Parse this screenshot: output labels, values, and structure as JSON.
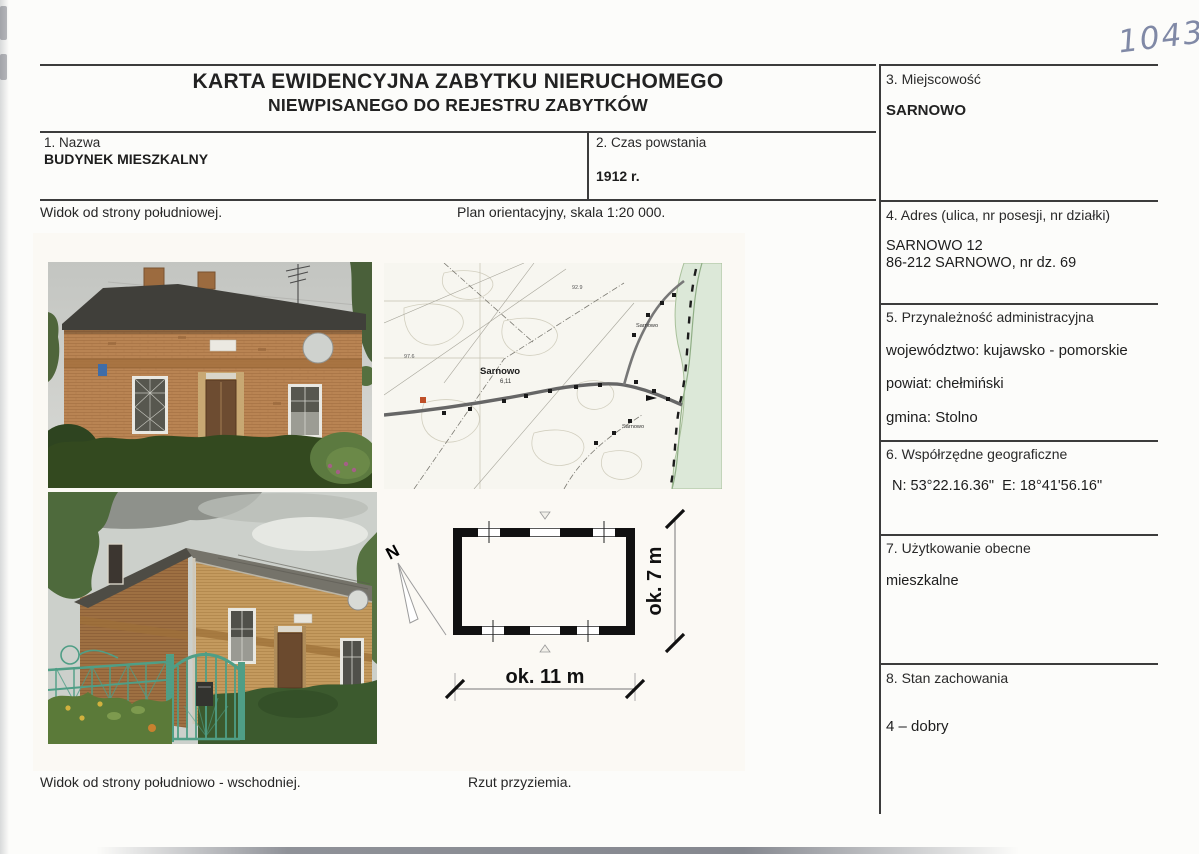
{
  "header": {
    "handwritten_number": "10438",
    "title_line1": "KARTA EWIDENCYJNA ZABYTKU NIERUCHOMEGO",
    "title_line2": "NIEWPISANEGO DO REJESTRU ZABYTKÓW"
  },
  "fields": {
    "nazwa": {
      "label": "1. Nazwa",
      "value": "BUDYNEK MIESZKALNY"
    },
    "czas_powstania": {
      "label": "2. Czas powstania",
      "value": "1912 r."
    },
    "miejscowosc": {
      "label": "3. Miejscowość",
      "value": "SARNOWO"
    },
    "adres": {
      "label": "4. Adres (ulica, nr posesji, nr działki)",
      "line1": "SARNOWO 12",
      "line2": "86-212 SARNOWO, nr dz. 69"
    },
    "przynaleznosc": {
      "label": "5. Przynależność administracyjna",
      "wojewodztwo": "województwo: kujawsko - pomorskie",
      "powiat": "powiat: chełmiński",
      "gmina": "gmina: Stolno"
    },
    "wspolrzedne": {
      "label": "6. Współrzędne geograficzne",
      "value": "N: 53°22.16.36\"  E: 18°41'56.16\""
    },
    "uzytkowanie": {
      "label": "7. Użytkowanie obecne",
      "value": "mieszkalne"
    },
    "stan": {
      "label": "8. Stan zachowania",
      "value": "4 – dobry"
    }
  },
  "captions": {
    "photo_south": "Widok od strony południowej.",
    "map": "Plan orientacyjny, skala 1:20 000.",
    "photo_southeast": "Widok od strony południowo - wschodniej.",
    "plan": "Rzut przyziemia."
  },
  "map": {
    "label_center": "Sarnowo",
    "label_center_sub": "6,11",
    "label_north": "Sarnowo",
    "label_south": "Sarnowo",
    "elevation_west": "97.6",
    "elevation_north": "92.9"
  },
  "plan": {
    "north_label": "N",
    "width_label": "ok. 11 m",
    "height_label": "ok. 7 m"
  }
}
